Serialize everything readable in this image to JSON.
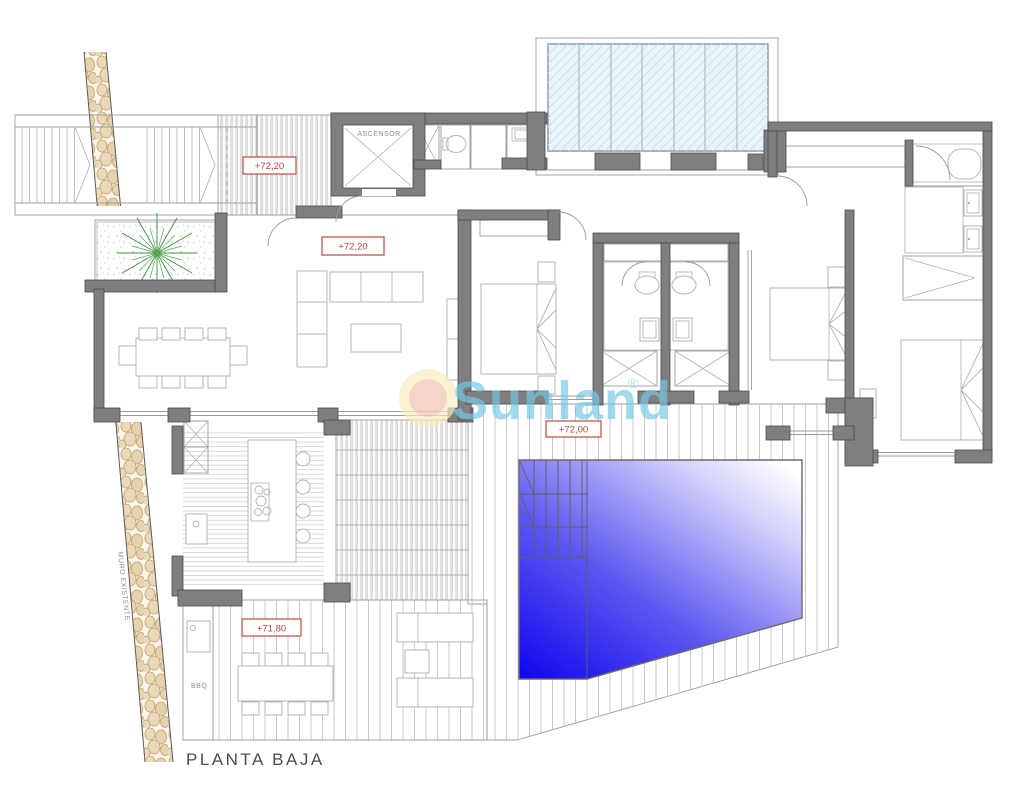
{
  "watermark": {
    "text": "Sunland",
    "registered": "®"
  },
  "labels": {
    "planta_baja": "PLANTA BAJA",
    "ascensor": "ASCENSOR",
    "bbq": "BBQ",
    "muro_existente": "MURO EXISTENTE"
  },
  "levels": {
    "entrance_pergola": "+72,20",
    "living_room": "+72,20",
    "pool_deck": "+72,00",
    "terrace": "+71,80"
  },
  "colors": {
    "wall_gray": "#7f7f7f",
    "label_red": "#bf4a44",
    "pool_deep_blue": "#0d06ee",
    "pool_mid_blue": "#5e58f0",
    "pool_light": "#ffffff",
    "glass_blue": "#e9f3f8",
    "stone_beige": "#ead9b8",
    "plant_green": "#3d8f3d",
    "watermark_blue": "#76c7e5",
    "sun_outer_yellow": "#f6ecbe",
    "sun_inner_pink": "#f2c7b8"
  }
}
